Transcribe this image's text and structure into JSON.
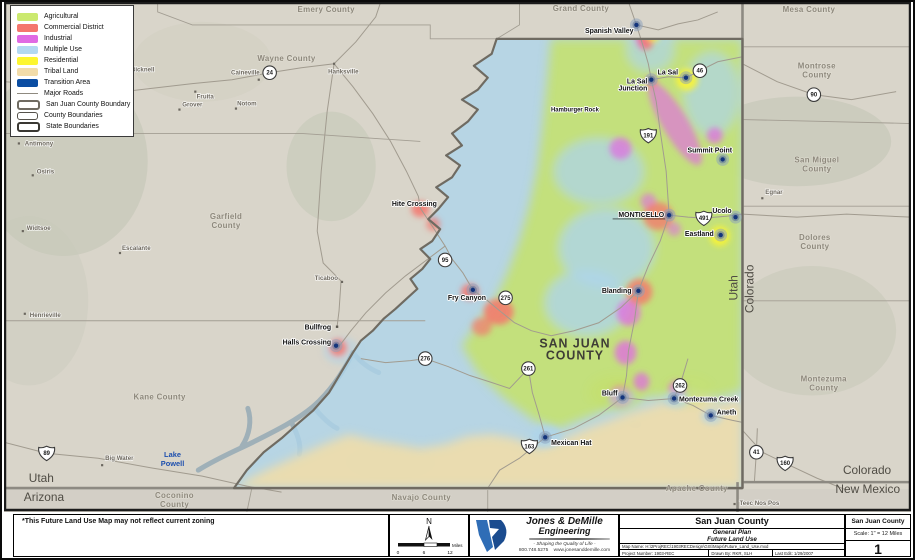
{
  "legend": {
    "items": [
      {
        "label": "Agricultural",
        "kind": "fill",
        "color": "#cbe96f"
      },
      {
        "label": "Commercial District",
        "kind": "fill",
        "color": "#f4766d"
      },
      {
        "label": "Industrial",
        "kind": "fill",
        "color": "#e06ae3"
      },
      {
        "label": "Multiple Use",
        "kind": "fill",
        "color": "#b3d9f2"
      },
      {
        "label": "Residential",
        "kind": "fill",
        "color": "#fdf62f"
      },
      {
        "label": "Tribal Land",
        "kind": "fill",
        "color": "#f2dca9"
      },
      {
        "label": "Transition Area",
        "kind": "fill",
        "color": "#0b4da2"
      },
      {
        "label": "Major Roads",
        "kind": "line",
        "color": "#8f8a80"
      },
      {
        "label": "San Juan County Boundary",
        "kind": "outline",
        "color": "#6f6b62",
        "weight": 2.5
      },
      {
        "label": "County Boundaries",
        "kind": "outline",
        "color": "#55524b",
        "weight": 1
      },
      {
        "label": "State Boundaries",
        "kind": "outline",
        "color": "#3a3833",
        "weight": 2.5
      }
    ]
  },
  "map": {
    "footnote": "*This Future Land Use Map may not reflect current zoning",
    "big_label": {
      "lines": [
        "SAN JUAN",
        "COUNTY"
      ],
      "x": 576,
      "y": 347
    },
    "lake_label": {
      "lines": [
        "Lake",
        "Powell"
      ],
      "x": 170,
      "y": 457
    },
    "county_labels": [
      {
        "lines": [
          "Emery County"
        ],
        "x": 325,
        "y": 10
      },
      {
        "lines": [
          "Grand County"
        ],
        "x": 582,
        "y": 9
      },
      {
        "lines": [
          "Mesa County"
        ],
        "x": 812,
        "y": 10
      },
      {
        "lines": [
          "Wayne County"
        ],
        "x": 285,
        "y": 59
      },
      {
        "lines": [
          "Montrose",
          "County"
        ],
        "x": 820,
        "y": 67
      },
      {
        "lines": [
          "San Miguel",
          "County"
        ],
        "x": 820,
        "y": 161
      },
      {
        "lines": [
          "Garfield",
          "County"
        ],
        "x": 224,
        "y": 218
      },
      {
        "lines": [
          "Dolores",
          "County"
        ],
        "x": 818,
        "y": 239
      },
      {
        "lines": [
          "Kane County"
        ],
        "x": 157,
        "y": 399
      },
      {
        "lines": [
          "Montezuma",
          "County"
        ],
        "x": 827,
        "y": 381
      },
      {
        "lines": [
          "Coconino",
          "County"
        ],
        "x": 172,
        "y": 498
      },
      {
        "lines": [
          "Navajo County"
        ],
        "x": 421,
        "y": 500
      },
      {
        "lines": [
          "Apache County"
        ],
        "x": 699,
        "y": 491
      }
    ],
    "state_labels": [
      {
        "text": "Utah",
        "x": 25,
        "y": 482,
        "anchor": "start"
      },
      {
        "text": "Arizona",
        "x": 20,
        "y": 501,
        "anchor": "start"
      },
      {
        "text": "Colorado",
        "x": 895,
        "y": 474,
        "anchor": "end"
      },
      {
        "text": "New Mexico",
        "x": 904,
        "y": 493,
        "anchor": "end"
      },
      {
        "text": "Utah",
        "x": 740,
        "y": 287,
        "anchor": "middle",
        "rotate": -90
      },
      {
        "text": "Colorado",
        "x": 756,
        "y": 288,
        "anchor": "middle",
        "rotate": -90
      }
    ],
    "towns": [
      {
        "name": "Spanish Valley",
        "x": 635,
        "y": 31,
        "anchor": "end",
        "dot": [
          638,
          23
        ]
      },
      {
        "name": "La Sal Junction",
        "lines": [
          "La Sal",
          "Junction"
        ],
        "x": 649,
        "y": 82,
        "anchor": "end",
        "dot": [
          653,
          78
        ]
      },
      {
        "name": "La Sal",
        "x": 680,
        "y": 73,
        "anchor": "end",
        "dot": [
          688,
          76
        ]
      },
      {
        "name": "Summit Point",
        "x": 712,
        "y": 151,
        "anchor": "middle",
        "dot": [
          725,
          158
        ]
      },
      {
        "name": "MONTICELLO",
        "x": 666,
        "y": 216,
        "anchor": "end",
        "dot": [
          671,
          214
        ],
        "underline": true
      },
      {
        "name": "Ucolo",
        "x": 734,
        "y": 212,
        "anchor": "end",
        "dot": [
          738,
          216
        ]
      },
      {
        "name": "Eastland",
        "x": 716,
        "y": 235,
        "anchor": "end",
        "dot": [
          723,
          234
        ]
      },
      {
        "name": "Blanding",
        "x": 633,
        "y": 292,
        "anchor": "end",
        "dot": [
          640,
          290
        ]
      },
      {
        "name": "Fry Canyon",
        "x": 467,
        "y": 299,
        "anchor": "middle",
        "dot": [
          473,
          289
        ]
      },
      {
        "name": "Hite Crossing",
        "x": 414,
        "y": 205,
        "anchor": "middle"
      },
      {
        "name": "Hamburger Rock",
        "x": 576,
        "y": 110,
        "anchor": "middle",
        "small": true
      },
      {
        "name": "Bullfrog",
        "x": 330,
        "y": 329,
        "anchor": "end",
        "minordot": [
          336,
          326
        ]
      },
      {
        "name": "Halls Crossing",
        "x": 330,
        "y": 344,
        "anchor": "end",
        "dot": [
          335,
          345
        ]
      },
      {
        "name": "Bluff",
        "x": 619,
        "y": 395,
        "anchor": "end",
        "dot": [
          624,
          397
        ]
      },
      {
        "name": "Mexican Hat",
        "x": 552,
        "y": 445,
        "anchor": "start",
        "dot": [
          546,
          437
        ]
      },
      {
        "name": "Montezuma Creek",
        "x": 681,
        "y": 401,
        "anchor": "start",
        "dot": [
          676,
          398
        ]
      },
      {
        "name": "Aneth",
        "x": 719,
        "y": 414,
        "anchor": "start",
        "dot": [
          713,
          415
        ]
      }
    ],
    "places": [
      {
        "name": "Caineville",
        "x": 258,
        "y": 73,
        "anchor": "end",
        "dot": [
          257,
          78
        ]
      },
      {
        "name": "Hanksville",
        "x": 327,
        "y": 72,
        "anchor": "start",
        "dot": [
          333,
          62
        ]
      },
      {
        "name": "Torrey",
        "x": 55,
        "y": 82,
        "anchor": "middle",
        "dot": [
          69,
          86
        ]
      },
      {
        "name": "Bicknell",
        "x": 128,
        "y": 70,
        "anchor": "start",
        "dot": [
          125,
          70
        ]
      },
      {
        "name": "Fruita",
        "x": 203,
        "y": 97,
        "anchor": "middle",
        "dot": [
          193,
          90
        ]
      },
      {
        "name": "Grover",
        "x": 190,
        "y": 105,
        "anchor": "middle",
        "dot": [
          177,
          108
        ]
      },
      {
        "name": "Notom",
        "x": 245,
        "y": 104,
        "anchor": "middle",
        "dot": [
          234,
          107
        ]
      },
      {
        "name": "Antimony",
        "x": 21,
        "y": 144,
        "anchor": "start",
        "dot": [
          15,
          142
        ]
      },
      {
        "name": "Osiris",
        "x": 33,
        "y": 172,
        "anchor": "start",
        "dot": [
          29,
          174
        ]
      },
      {
        "name": "Widtsoe",
        "x": 23,
        "y": 229,
        "anchor": "start",
        "dot": [
          19,
          230
        ]
      },
      {
        "name": "Henrieville",
        "x": 26,
        "y": 316,
        "anchor": "start",
        "dot": [
          21,
          313
        ]
      },
      {
        "name": "Escalante",
        "x": 119,
        "y": 249,
        "anchor": "start",
        "dot": [
          117,
          252
        ]
      },
      {
        "name": "Ticaboo",
        "x": 337,
        "y": 279,
        "anchor": "end",
        "dot": [
          341,
          281
        ]
      },
      {
        "name": "Big Water",
        "x": 102,
        "y": 460,
        "anchor": "start",
        "dot": [
          99,
          465
        ]
      },
      {
        "name": "Egnar",
        "x": 768,
        "y": 193,
        "anchor": "start",
        "dot": [
          765,
          197
        ]
      },
      {
        "name": "Teec Nos Pos",
        "x": 742,
        "y": 505,
        "anchor": "start",
        "dot": [
          737,
          504
        ]
      }
    ],
    "shields": [
      {
        "num": "24",
        "x": 268,
        "y": 71,
        "type": "circle"
      },
      {
        "num": "46",
        "x": 702,
        "y": 69,
        "type": "circle"
      },
      {
        "num": "90",
        "x": 817,
        "y": 93,
        "type": "circle"
      },
      {
        "num": "95",
        "x": 445,
        "y": 259,
        "type": "circle"
      },
      {
        "num": "275",
        "x": 506,
        "y": 297,
        "type": "circle"
      },
      {
        "num": "276",
        "x": 425,
        "y": 358,
        "type": "circle"
      },
      {
        "num": "261",
        "x": 529,
        "y": 368,
        "type": "circle"
      },
      {
        "num": "262",
        "x": 682,
        "y": 385,
        "type": "circle"
      },
      {
        "num": "41",
        "x": 759,
        "y": 452,
        "type": "circle"
      },
      {
        "num": "191",
        "x": 650,
        "y": 134,
        "type": "us"
      },
      {
        "num": "491",
        "x": 706,
        "y": 217,
        "type": "us"
      },
      {
        "num": "89",
        "x": 43,
        "y": 453,
        "type": "us"
      },
      {
        "num": "163",
        "x": 530,
        "y": 446,
        "type": "us"
      },
      {
        "num": "160",
        "x": 788,
        "y": 463,
        "type": "us"
      }
    ]
  },
  "scalebar": {
    "north_label": "N",
    "miles_label": "Miles",
    "ticks": [
      "0",
      "6",
      "12"
    ]
  },
  "logo": {
    "company_line1": "Jones & DeMille",
    "company_line2": "Engineering",
    "tagline": "- Shaping the Quality of Life -",
    "phone": "800.748.5275",
    "website": "www.jonesanddemille.com"
  },
  "titleblock": {
    "county": "San Juan County",
    "plan_line1": "General Plan",
    "plan_line2": "Future Land Use",
    "map_name": "Map Name: H:\\2ProjREC\\1903RECDesign\\GIS\\Maps\\Future_Land_Use.mxd",
    "project_number": "Project Number: 1903-REC",
    "drawn_by": "Drawn By: RKR, SLH",
    "last_edit": "Last Edit: 1/29/2007"
  },
  "sheetblock": {
    "county": "San Juan County",
    "scale": "Scale: 1\" = 12 Miles",
    "number": "1"
  }
}
